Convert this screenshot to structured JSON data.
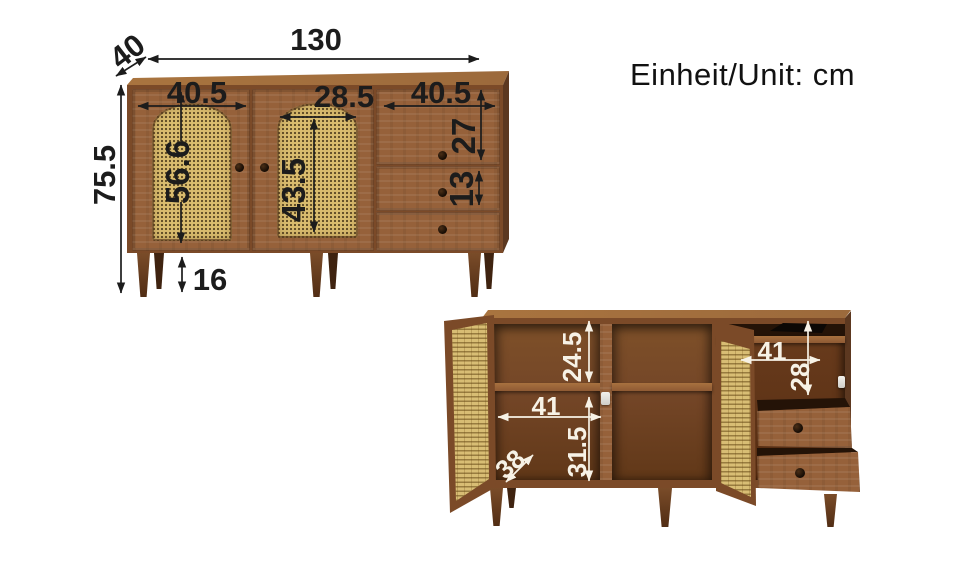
{
  "unit_label": "Einheit/Unit: cm",
  "closed_view": {
    "overall_width": "130",
    "overall_depth": "40",
    "overall_height": "75.5",
    "left_door_width": "40.5",
    "left_door_panel_height": "56.6",
    "middle_panel_width": "28.5",
    "middle_panel_height": "43.5",
    "drawer_section_width": "40.5",
    "top_drawer_height": "27",
    "middle_drawer_height": "13",
    "leg_height": "16"
  },
  "open_view": {
    "top_shelf_height": "24.5",
    "left_compartment_width": "41",
    "bottom_compartment_height": "31.5",
    "interior_depth": "38",
    "right_compartment_width": "41",
    "right_compartment_height": "28"
  },
  "palette": {
    "background": "#ffffff",
    "wood_front": "#96613a",
    "wood_frame": "#7b4a28",
    "wood_top": "#a4703f",
    "wood_side": "#5c3820",
    "wood_interior": "#7b4c29",
    "cane": "#d9bc6e",
    "dimension_color_closed": "#1c1c1c",
    "dimension_color_open": "#f7f2e6"
  }
}
